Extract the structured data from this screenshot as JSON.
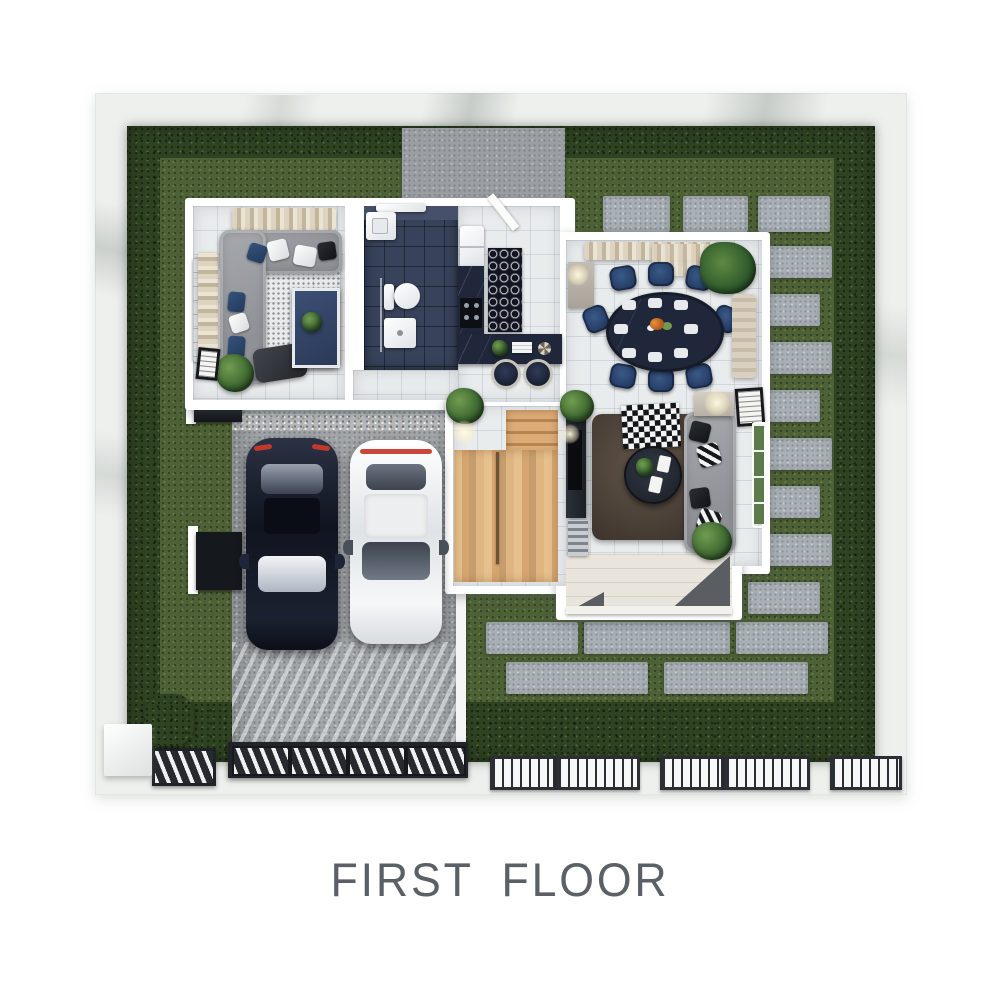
{
  "title": {
    "text": "FIRST FLOOR"
  },
  "theme": {
    "page-bg": "#ffffff",
    "title-color": "#5a6065",
    "wall": "#eef0ee",
    "hedge": "#2f4222",
    "lawn": "#4e6136",
    "paver": "#a9b0b5",
    "concrete": "#9b9fa3",
    "driveway": "#a2a6a9",
    "tile": "#e9eced",
    "house-wall": "#ffffff",
    "navy-dark": "#20273a",
    "navy-tile": "#38425a",
    "navy-velvet": "#27406a",
    "sofa-gray": "#9a9da1",
    "rug-brown": "#463b31",
    "wood": "#d2a06e",
    "car-navy": "#12161f",
    "car-white": "#f2f3f4",
    "metal-dark": "#24272b",
    "porch": "#e9e5dc"
  }
}
